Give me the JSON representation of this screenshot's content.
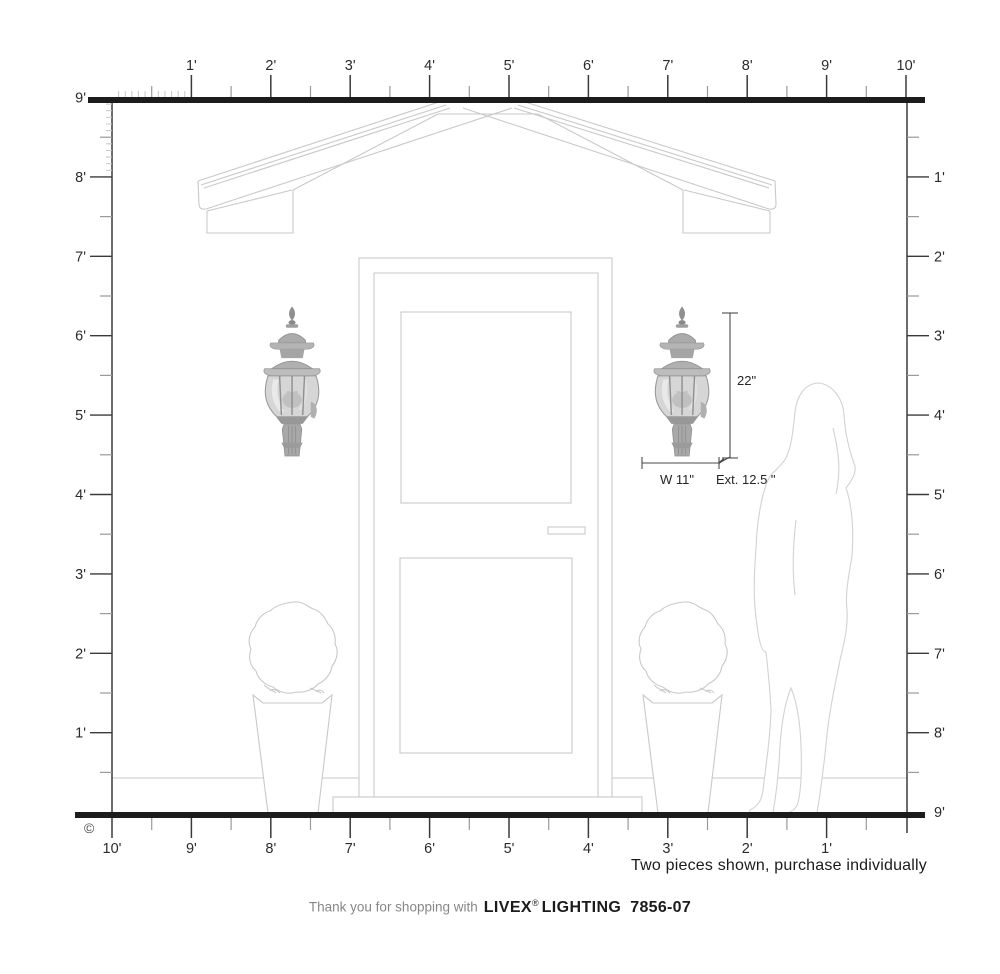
{
  "page": {
    "copyright_symbol": "©"
  },
  "rulers": {
    "top_labels": [
      "1'",
      "2'",
      "3'",
      "4'",
      "5'",
      "6'",
      "7'",
      "8'",
      "9'",
      "10'"
    ],
    "bottom_labels": [
      "10'",
      "9'",
      "8'",
      "7'",
      "6'",
      "5'",
      "4'",
      "3'",
      "2'",
      "1'"
    ],
    "left_labels": [
      "9'",
      "8'",
      "7'",
      "6'",
      "5'",
      "4'",
      "3'",
      "2'",
      "1'"
    ],
    "right_labels": [
      "1'",
      "2'",
      "3'",
      "4'",
      "5'",
      "6'",
      "7'",
      "8'",
      "9'"
    ]
  },
  "dimensions": {
    "height_label": "22\"",
    "width_label": "W 11\"",
    "extension_label": "Ext. 12.5 \""
  },
  "notes": {
    "purchase_note": "Two pieces shown, purchase individually"
  },
  "footer": {
    "thanks": "Thank you for shopping with",
    "brand": "LIVEX",
    "registered": "®",
    "brand2": "LIGHTING",
    "model": "7856-07"
  },
  "scene": {
    "left_fixture": "wall-lantern-photo",
    "right_fixture": "wall-lantern-photo",
    "elements": [
      "gable-roof-line-drawing",
      "entry-door-line-drawing",
      "topiary-planter-left",
      "topiary-planter-right",
      "woman-silhouette"
    ]
  },
  "colors": {
    "ruler_bar": "#1c1c1c",
    "ruler_tick": "#3a3a3a",
    "ruler_minor_tick": "#9a9a9a",
    "inch_tick": "#c6c6c6",
    "label_text": "#2b2b2b",
    "drawing_line": "#c9c9c9",
    "dimension_line": "#4a4a4a",
    "muted_text": "#878787",
    "dark_text": "#1b1b1b"
  }
}
